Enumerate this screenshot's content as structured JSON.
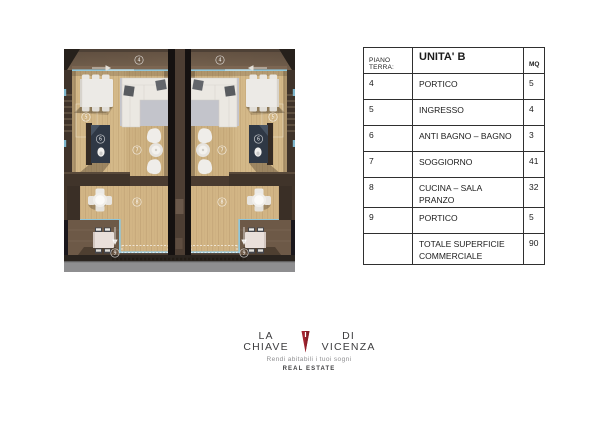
{
  "plan": {
    "rooms": {
      "portico_top": "4",
      "ingresso": "5",
      "bagno": "6",
      "soggiorno": "7",
      "cucina": "8",
      "portico_bottom": "9"
    }
  },
  "table": {
    "header": {
      "floor_label": "PIANO TERRA:",
      "unit_label": "UNITA' B",
      "area_label": "MQ"
    },
    "rows": [
      {
        "num": "4",
        "name": "PORTICO",
        "mq": "5"
      },
      {
        "num": "5",
        "name": "INGRESSO",
        "mq": "4"
      },
      {
        "num": "6",
        "name": "ANTI BAGNO – BAGNO",
        "mq": "3"
      },
      {
        "num": "7",
        "name": "SOGGIORNO",
        "mq": "41"
      },
      {
        "num": "8",
        "name": "CUCINA – SALA PRANZO",
        "mq": "32"
      },
      {
        "num": "9",
        "name": "PORTICO",
        "mq": "5"
      }
    ],
    "total_row": {
      "num": "",
      "name": "TOTALE SUPERFICIE COMMERCIALE",
      "mq": "90"
    }
  },
  "logo": {
    "name_left": "LA CHIAVE",
    "name_right": "DI VICENZA",
    "tagline": "Rendi abitabili i tuoi sogni",
    "subtitle": "REAL ESTATE"
  },
  "colors": {
    "brand_red": "#a32430",
    "roof_brown": "#6b5949",
    "wall_brown": "#4a3b30",
    "wood_floor": "#d4b989",
    "rug_gray": "#c3c4cb",
    "glass_blue": "#8fc6da",
    "portico_floor": "#6d5947",
    "cabinet_navy": "#2f3845",
    "base_gray": "#8e8e90"
  }
}
